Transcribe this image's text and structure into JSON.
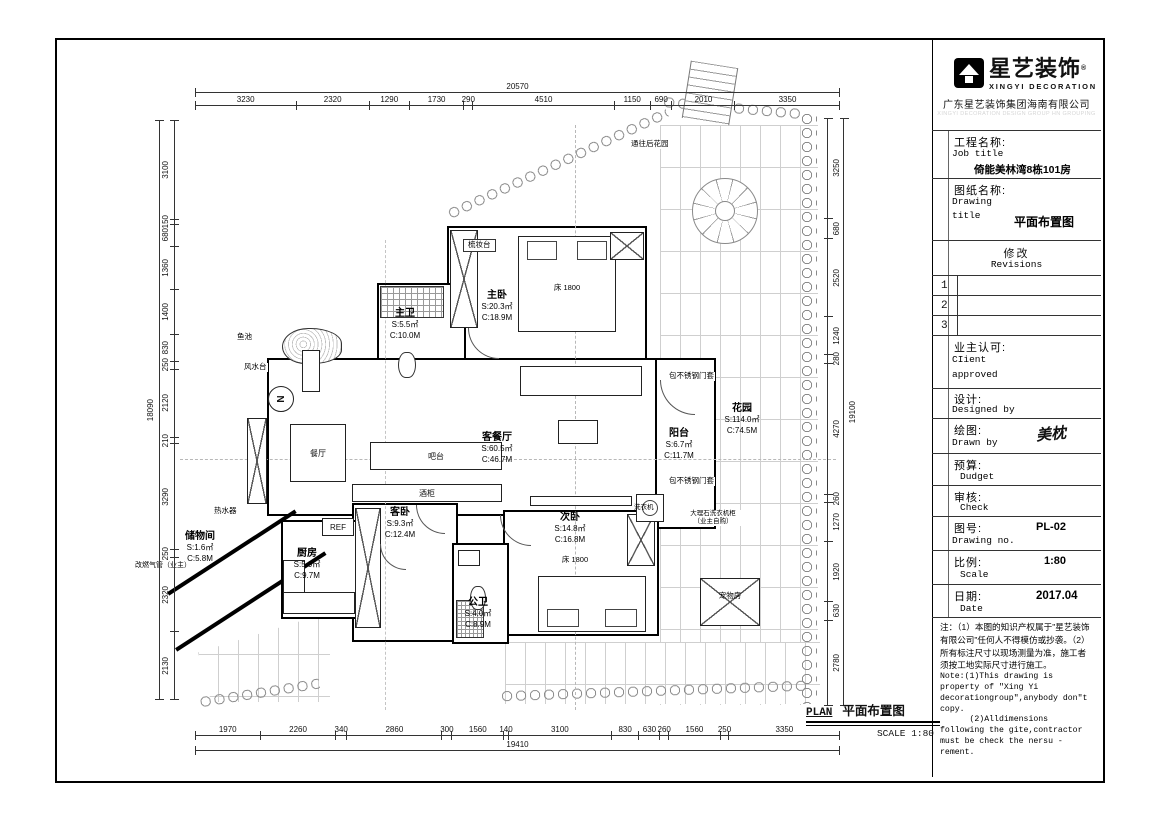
{
  "tb": {
    "brand": {
      "icon": "xingyi-house-logo",
      "cn": "星艺装饰",
      "reg": "®",
      "en": "XINGYI DECORATION",
      "company": "广东星艺装饰集团海南有限公司",
      "watermark": "XINGYI DECORATION DESIGN GROUP HN GROUPING"
    },
    "job": {
      "cn": "工程名称:",
      "en": "Job title",
      "value": "倚能美林湾8栋101房"
    },
    "dtitle": {
      "cn": "图纸名称:",
      "en1": "Drawing",
      "en2": "title",
      "value": "平面布置图"
    },
    "revisions": {
      "cn": "修改",
      "en": "Revisions",
      "rows": [
        "1",
        "2",
        "3"
      ]
    },
    "client": {
      "cn": "业主认可:",
      "en1": "CIient",
      "en2": "approved"
    },
    "designed": {
      "cn": "设计:",
      "en": "Designed by"
    },
    "drawn": {
      "cn": "绘图:",
      "en": "Drawn by",
      "signature": "美枕"
    },
    "budget": {
      "cn": "预算:",
      "en": "Dudget"
    },
    "check": {
      "cn": "审核:",
      "en": "Check"
    },
    "dno": {
      "cn": "图号:",
      "en": "Drawing no.",
      "value": "PL-02"
    },
    "scale": {
      "cn": "比例:",
      "en": "Scale",
      "value": "1:80"
    },
    "date": {
      "cn": "日期:",
      "en": "Date",
      "value": "2017.04"
    },
    "notes": {
      "cn": "注：（1）本图的知识产权属于\"星艺装饰有限公司\"任何人不得模仿或抄袭。（2）所有标注尺寸以现场测量为准，施工者须按工地实际尺寸进行施工。",
      "en1": "Note:(1)This drawing is property of \"Xing Yi decorationgroup\",anybody don\"t copy.",
      "en2": "      (2)Alldimensions following the gite,contractor must be check the nersu -rement."
    }
  },
  "plan": {
    "north": "N",
    "rooms": {
      "master": {
        "name": "主卧",
        "s": "S:20.3㎡",
        "c": "C:18.9M"
      },
      "mbath": {
        "name": "主卫",
        "s": "S:5.5㎡",
        "c": "C:10.0M"
      },
      "living": {
        "name": "客餐厅",
        "s": "S:60.5㎡",
        "c": "C:46.7M"
      },
      "balcony": {
        "name": "阳台",
        "s": "S:6.7㎡",
        "c": "C:11.7M"
      },
      "garden": {
        "name": "花园",
        "s": "S:114.0㎡",
        "c": "C:74.5M"
      },
      "second": {
        "name": "次卧",
        "s": "S:14.8㎡",
        "c": "C:16.8M"
      },
      "guest": {
        "name": "客卧",
        "s": "S:9.3㎡",
        "c": "C:12.4M"
      },
      "pbath": {
        "name": "公卫",
        "s": "S:4.0㎡",
        "c": "C:8.9M"
      },
      "kitchen": {
        "name": "厨房",
        "s": "S:5.9㎡",
        "c": "C:9.7M"
      },
      "storage": {
        "name": "储物间",
        "s": "S:1.6㎡",
        "c": "C:5.8M"
      }
    },
    "labels": {
      "dresser": "梳妆台",
      "bed_master": "床 1800",
      "bed_second": "床 1800",
      "fish_pond": "鱼池",
      "fengshui": "风水台",
      "dining": "餐厅",
      "bar": "吧台",
      "wine": "酒柜",
      "ref": "REF",
      "heater": "热水器",
      "gas": "改燃气管（业主）",
      "door_frame_top": "包不锈钢门套",
      "door_frame_bottom": "包不锈钢门套",
      "washer": "洗衣机",
      "marble1": "大理石洗衣机柜",
      "marble2": "（业主自购）",
      "back_garden": "通往后花园",
      "pet": "宠物房"
    },
    "dims": {
      "top": {
        "overall": "20570",
        "segments": [
          3230,
          2320,
          1290,
          1730,
          290,
          4510,
          1150,
          690,
          2010,
          3350
        ]
      },
      "bottom": {
        "overall": "19410",
        "segments": [
          1970,
          2260,
          340,
          2860,
          300,
          1560,
          140,
          3100,
          830,
          630,
          260,
          1560,
          250,
          3350
        ]
      },
      "left": {
        "overall": "18090",
        "segments": [
          3100,
          150,
          680,
          1360,
          1400,
          830,
          250,
          2120,
          210,
          3290,
          250,
          2320,
          2130
        ]
      },
      "right": {
        "overall": "19100",
        "segments": [
          3250,
          680,
          2520,
          1240,
          280,
          4270,
          260,
          1270,
          1920,
          630,
          2780
        ]
      }
    },
    "footer": {
      "plan": "PLAN",
      "title": "平面布置图",
      "scale": "SCALE  1:80"
    }
  }
}
